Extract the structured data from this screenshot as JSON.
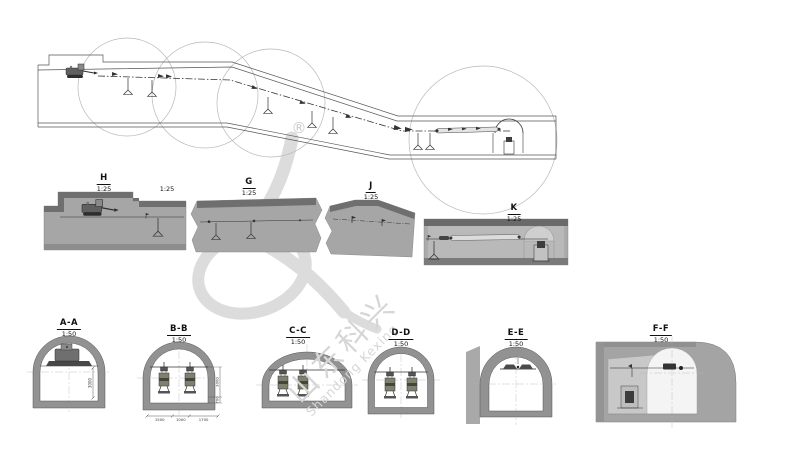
{
  "watermark": {
    "registered_mark": "®",
    "text_cn": "山东科兴",
    "text_en": "Shandong Kexing"
  },
  "detail_views": {
    "h": {
      "label": "H",
      "scale": "1:25"
    },
    "g": {
      "label": "G",
      "scale": "1:25"
    },
    "j": {
      "label": "J",
      "scale": "1:25"
    },
    "k": {
      "label": "K",
      "scale": "1:25"
    },
    "extra_scale": "1:25"
  },
  "cross_sections": [
    {
      "label": "A-A",
      "scale": "1:50",
      "dim_height": "3000"
    },
    {
      "label": "B-B",
      "scale": "1:50",
      "dim_heights": [
        "3000",
        "700"
      ],
      "dim_widths": [
        "1500",
        "1000",
        "1700"
      ]
    },
    {
      "label": "C-C",
      "scale": "1:50"
    },
    {
      "label": "D-D",
      "scale": "1:50"
    },
    {
      "label": "E-E",
      "scale": "1:50"
    },
    {
      "label": "F-F",
      "scale": "1:50"
    }
  ],
  "colors": {
    "section_fill": "#a6a6a6",
    "section_top_band": "#6f6f6f",
    "tunnel_ring": "#929292",
    "line": "#333333",
    "watermark": "#d6d6d6"
  }
}
